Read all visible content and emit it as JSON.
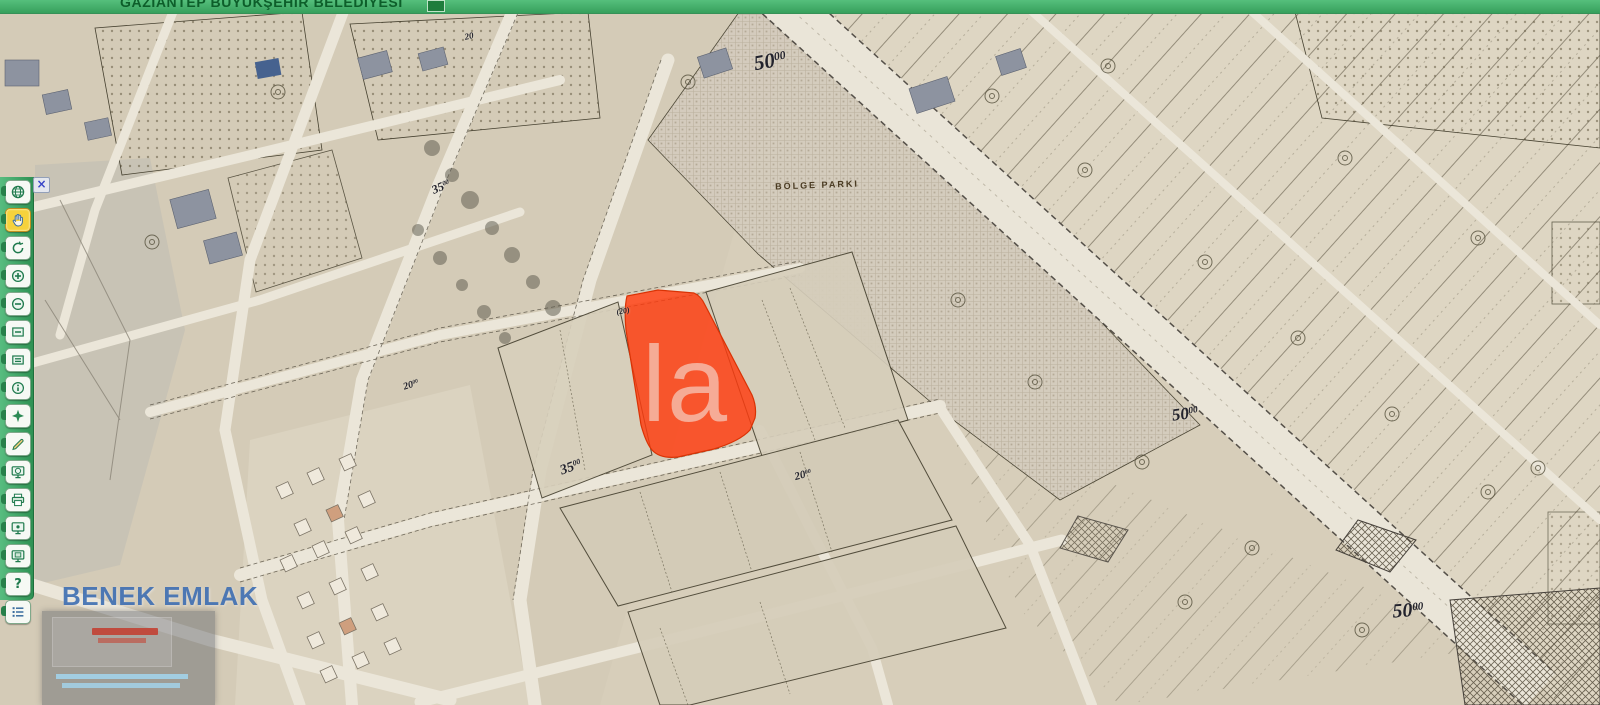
{
  "header": {
    "title": "GAZİANTEP BÜYÜKŞEHİR BELEDİYESİ"
  },
  "toolbar": {
    "close_glyph": "×",
    "buttons": [
      {
        "name": "full-extent",
        "icon": "globe"
      },
      {
        "name": "pan",
        "icon": "hand",
        "active": true
      },
      {
        "name": "refresh",
        "icon": "refresh"
      },
      {
        "name": "zoom-in",
        "icon": "zoom-in"
      },
      {
        "name": "zoom-out",
        "icon": "zoom-out"
      },
      {
        "name": "previous-extent",
        "icon": "extent-back"
      },
      {
        "name": "next-extent",
        "icon": "extent-forward"
      },
      {
        "name": "identify",
        "icon": "info"
      },
      {
        "name": "select",
        "icon": "select-star"
      },
      {
        "name": "measure",
        "icon": "measure"
      },
      {
        "name": "overview-map",
        "icon": "screen-globe"
      },
      {
        "name": "print",
        "icon": "print"
      },
      {
        "name": "locate",
        "icon": "screen-pin"
      },
      {
        "name": "snapshot",
        "icon": "screen-copy"
      },
      {
        "name": "help",
        "icon": "question",
        "glyph": "?"
      },
      {
        "name": "legend",
        "icon": "legend"
      }
    ]
  },
  "map": {
    "highlight_parcel_color": "#ff3a0d",
    "labels": [
      {
        "name": "road-width-50-top",
        "main": "50",
        "sup": "00",
        "x": 770,
        "y": 61,
        "rot": -10,
        "size": 21
      },
      {
        "name": "road-width-50-middle",
        "main": "50",
        "sup": "00",
        "x": 1185,
        "y": 414,
        "rot": -8,
        "size": 17
      },
      {
        "name": "road-width-50-bottom",
        "main": "50",
        "sup": "00",
        "x": 1408,
        "y": 611,
        "rot": -4,
        "size": 20
      },
      {
        "name": "road-width-35-upper",
        "main": "35",
        "sup": "00",
        "x": 441,
        "y": 187,
        "rot": -24,
        "size": 12
      },
      {
        "name": "road-width-35-lower",
        "main": "35",
        "sup": "00",
        "x": 571,
        "y": 468,
        "rot": -20,
        "size": 14
      },
      {
        "name": "road-width-20-top",
        "main": "20",
        "sup": "",
        "x": 469,
        "y": 36,
        "rot": -12,
        "size": 9
      },
      {
        "name": "road-width-20-parcel",
        "main": "(20)",
        "sup": "",
        "x": 623,
        "y": 311,
        "rot": -10,
        "size": 8
      },
      {
        "name": "road-width-20-lower",
        "main": "20",
        "sup": "00",
        "x": 803,
        "y": 475,
        "rot": -15,
        "size": 11
      },
      {
        "name": "road-width-20-left",
        "main": "20",
        "sup": "00",
        "x": 411,
        "y": 385,
        "rot": -18,
        "size": 10
      },
      {
        "name": "bolge-parki",
        "main": "BÖLGE PARKI",
        "sup": "",
        "x": 817,
        "y": 185,
        "rot": -2,
        "size": 9,
        "cls": "park"
      }
    ]
  },
  "watermark": {
    "brand": "BENEK EMLAK",
    "overlay_text": "la"
  }
}
